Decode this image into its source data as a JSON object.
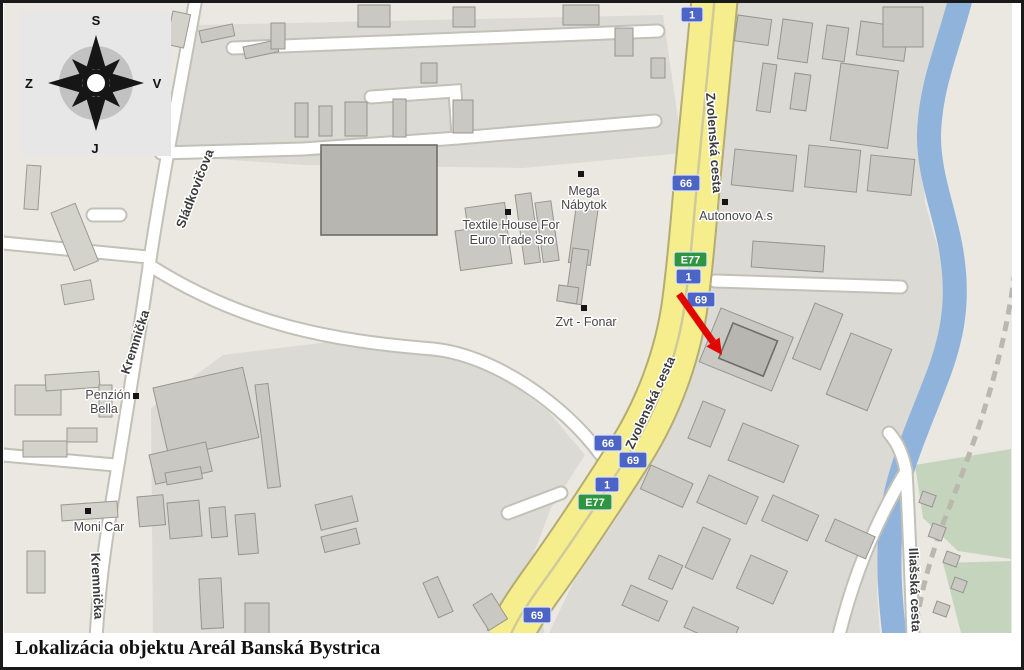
{
  "caption": "Lokalizácia objektu Areál Banská Bystrica",
  "compass": {
    "north": "S",
    "east": "V",
    "south": "J",
    "west": "Z"
  },
  "streets": {
    "zvolenska_top": "Zvolenská cesta",
    "zvolenska_mid": "Zvolenská cesta",
    "sladkovicova": "Sládkovičova",
    "kremnicka_upper": "Kremnička",
    "kremnicka_lower": "Kremnička",
    "iliasska": "Iliašská cesta"
  },
  "places": {
    "mega_nabytok": {
      "line1": "Mega",
      "line2": "Nábytok"
    },
    "textile_house": {
      "line1": "Textile House For",
      "line2": "Euro Trade Sro"
    },
    "zvt_fonar": {
      "line1": "Zvt - Fonar"
    },
    "autonovo": {
      "line1": "Autonovo A.s"
    },
    "penzion_bella": {
      "line1": "Penzión",
      "line2": "Bella"
    },
    "moni_car": {
      "line1": "Moni Car"
    }
  },
  "shields": {
    "s1_top": "1",
    "s66_upper": "66",
    "se77_upper": "E77",
    "s1_upper": "1",
    "s69_upper": "69",
    "s66_mid": "66",
    "s69_mid": "69",
    "s1_mid": "1",
    "se77_mid": "E77",
    "s69_bottom": "69"
  },
  "colors": {
    "highway_yellow": "#F6EE8C",
    "shield_blue": "#4C64C6",
    "shield_green": "#2E9640",
    "river_blue": "#90B3DB",
    "arrow_red": "#E10600",
    "green_area": "#C5D5BD",
    "map_beige": "#EAE8E0"
  }
}
